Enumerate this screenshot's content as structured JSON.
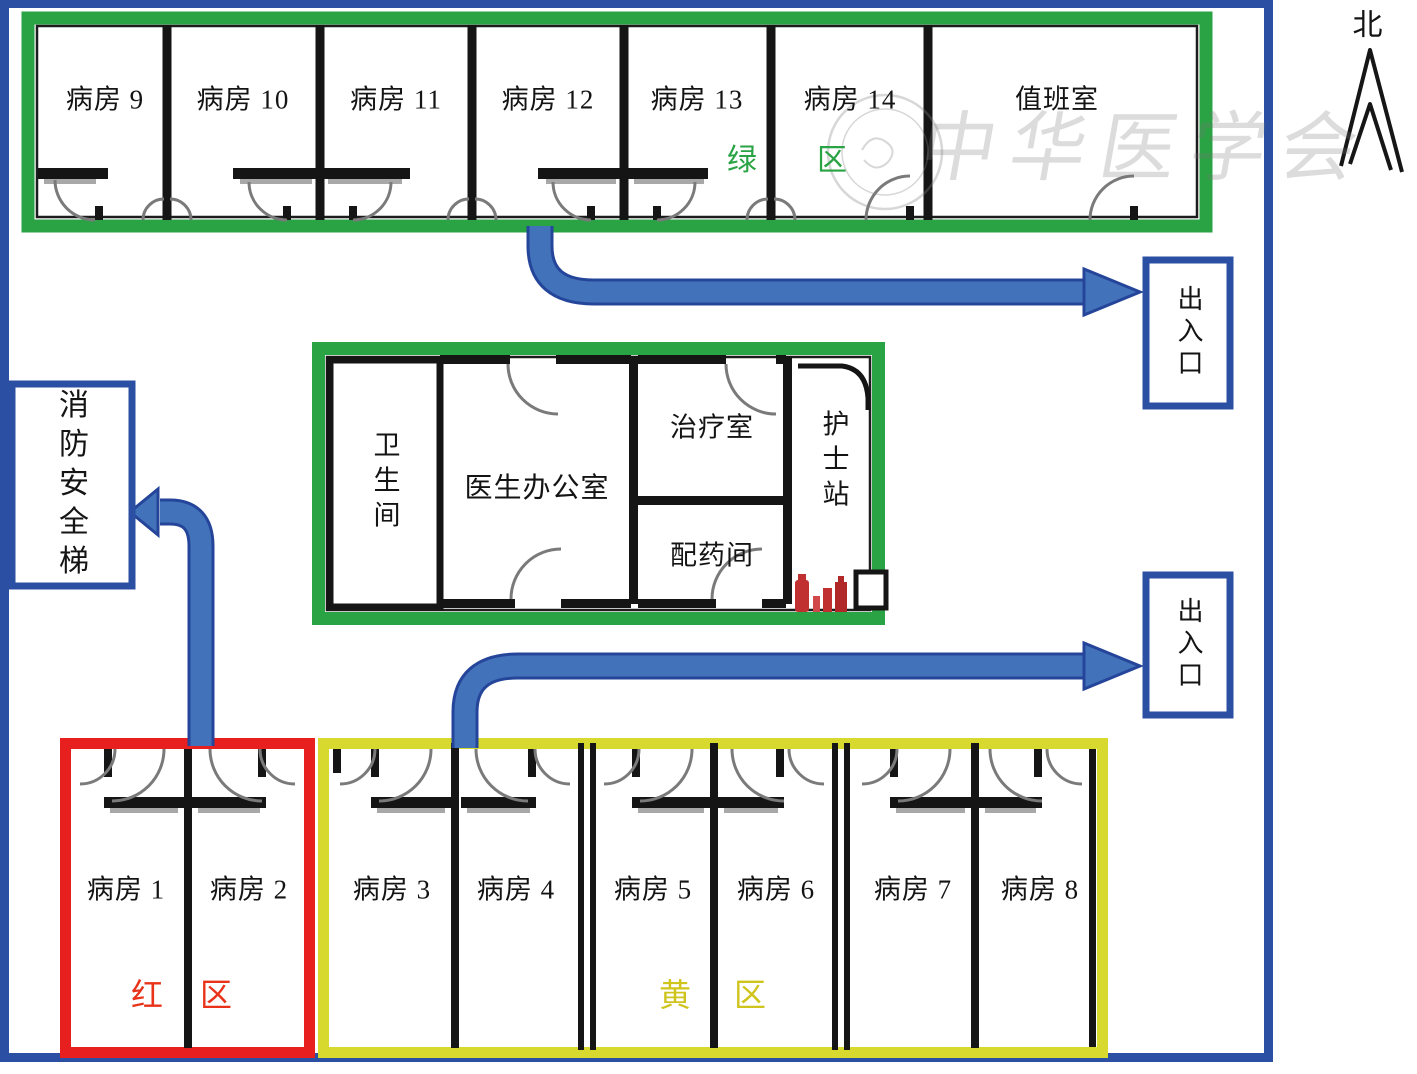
{
  "figure": {
    "type": "hospital-ward-floor-plan"
  },
  "compass": {
    "label": "北"
  },
  "watermark": {
    "text": "中华医学会"
  },
  "green_zone": {
    "label": "绿区",
    "rooms": [
      "病房 9",
      "病房 10",
      "病房 11",
      "病房 12",
      "病房 13",
      "病房 14",
      "值班室"
    ]
  },
  "core_block": {
    "bathroom": "卫生间",
    "doctor_office": "医生办公室",
    "treatment_room": "治疗室",
    "dispensing_room": "配药间",
    "nurse_station": "护士站"
  },
  "red_zone": {
    "label": "红区",
    "rooms": [
      "病房 1",
      "病房 2"
    ]
  },
  "yellow_zone": {
    "label": "黄区",
    "rooms": [
      "病房 3",
      "病房 4",
      "病房 5",
      "病房 6",
      "病房 7",
      "病房 8"
    ]
  },
  "exits": {
    "top": "出入口",
    "bottom": "出入口",
    "fire_stairs": "消防安全梯"
  },
  "colors": {
    "wall": "#151515",
    "outer_border": "#2b4fa2",
    "green": "#2aa344",
    "red": "#e81f1f",
    "yellow": "#d7d92e",
    "arrow": "#4272ba"
  }
}
